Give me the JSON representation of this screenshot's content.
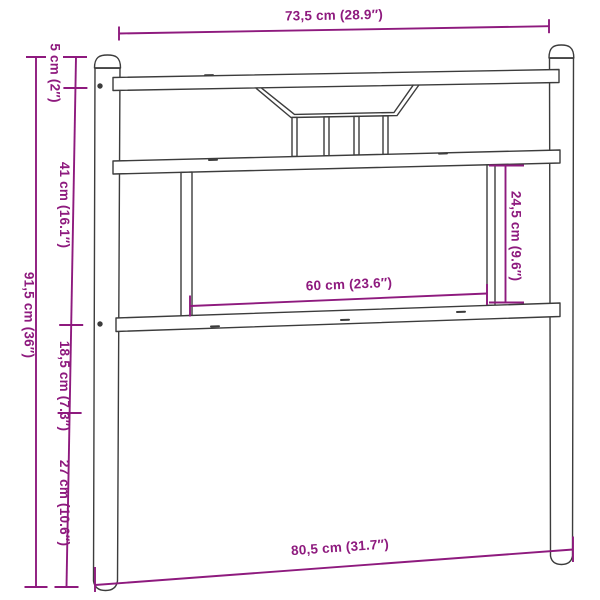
{
  "colors": {
    "accent": "#8e1a7e",
    "line": "#3c3c3c",
    "background": "#ffffff"
  },
  "labels": {
    "top_width": "73,5 cm (28.9″)",
    "total_width": "80,5 cm (31.7″)",
    "total_height": "91,5 cm (36″)",
    "cap_height": "5 cm (2″)",
    "upper_section": "41 cm (16.1″)",
    "middle_section": "18,5 cm (7.3″)",
    "lower_section": "27 cm (10.6″)",
    "panel_width": "60 cm (23.6″)",
    "panel_height": "24,5 cm (9.6″)"
  }
}
